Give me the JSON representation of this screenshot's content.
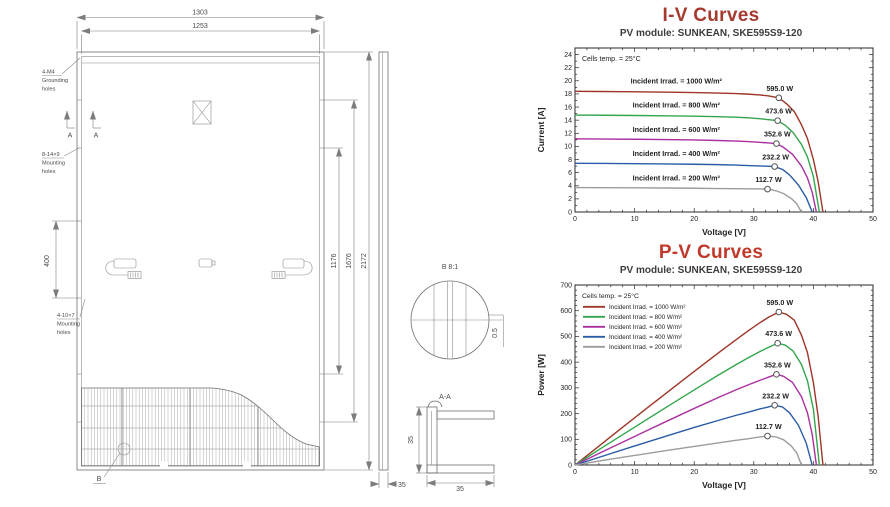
{
  "drawing": {
    "dims": {
      "width_total": "1303",
      "width_glass": "1253",
      "height_inner_holes": "1176",
      "height_outer_holes": "1676",
      "height_total": "2172",
      "hole_pitch": "400",
      "side_frame_width": "35",
      "section_height": "35",
      "section_width": "35",
      "cell_gap": "0.5"
    },
    "labels": {
      "grounding": [
        "4-M4",
        "Grounding",
        "holes"
      ],
      "mounting_upper": [
        "8-14×9",
        "Mounting",
        "holes"
      ],
      "mounting_lower": [
        "4-10×7",
        "Mounting",
        "holes"
      ],
      "section_marker": "A",
      "section_view": "A-A",
      "detail_marker": "B",
      "detail_view": "B 8:1"
    }
  },
  "chart_data": [
    {
      "type": "line",
      "title": "I-V Curves",
      "title_color": "#a63a2e",
      "subtitle": "PV module: SUNKEAN, SKE595S9-120",
      "xlabel": "Voltage [V]",
      "ylabel": "Current [A]",
      "xlim": [
        0,
        50
      ],
      "ylim": [
        0,
        25
      ],
      "xticks": [
        0,
        10,
        20,
        30,
        40,
        50
      ],
      "yticks": [
        0,
        2,
        4,
        6,
        8,
        10,
        12,
        14,
        16,
        18,
        20,
        22,
        24
      ],
      "x_minor": 2,
      "y_minor": 1,
      "note": "Cells temp. = 25°C",
      "legend": "inline",
      "series": [
        {
          "name": "Incident Irrad. = 1000 W/m²",
          "color": "#9e3528",
          "label_at": [
            17,
            19.6
          ],
          "mpp": [
            34.2,
            17.4
          ],
          "mpp_label": "595.0 W",
          "points": [
            [
              0,
              18.4
            ],
            [
              4,
              18.37
            ],
            [
              8,
              18.34
            ],
            [
              12,
              18.3
            ],
            [
              16,
              18.26
            ],
            [
              20,
              18.2
            ],
            [
              24,
              18.13
            ],
            [
              27,
              18.05
            ],
            [
              29,
              17.97
            ],
            [
              31,
              17.85
            ],
            [
              32.5,
              17.7
            ],
            [
              34.2,
              17.4
            ],
            [
              35.5,
              16.5
            ],
            [
              36.8,
              15.3
            ],
            [
              38,
              13.3
            ],
            [
              39,
              11.2
            ],
            [
              40,
              8.0
            ],
            [
              40.8,
              4.6
            ],
            [
              41.6,
              0
            ]
          ]
        },
        {
          "name": "Incident Irrad. = 800 W/m²",
          "color": "#33a64c",
          "label_at": [
            17,
            15.9
          ],
          "mpp": [
            34,
            13.93
          ],
          "mpp_label": "473.6 W",
          "points": [
            [
              0,
              14.78
            ],
            [
              5,
              14.75
            ],
            [
              10,
              14.71
            ],
            [
              15,
              14.66
            ],
            [
              20,
              14.6
            ],
            [
              24,
              14.53
            ],
            [
              27,
              14.45
            ],
            [
              29,
              14.36
            ],
            [
              31,
              14.22
            ],
            [
              32.5,
              14.08
            ],
            [
              34,
              13.93
            ],
            [
              35.3,
              13.2
            ],
            [
              36.6,
              12.1
            ],
            [
              38,
              10.3
            ],
            [
              39,
              8.4
            ],
            [
              40,
              5.4
            ],
            [
              41,
              0
            ]
          ]
        },
        {
          "name": "Incident Irrad. = 600 W/m²",
          "color": "#aa30a0",
          "label_at": [
            17,
            12.2
          ],
          "mpp": [
            33.8,
            10.43
          ],
          "mpp_label": "352.6 W",
          "points": [
            [
              0,
              11.15
            ],
            [
              5,
              11.12
            ],
            [
              10,
              11.09
            ],
            [
              15,
              11.04
            ],
            [
              20,
              10.98
            ],
            [
              24,
              10.9
            ],
            [
              27,
              10.82
            ],
            [
              29,
              10.73
            ],
            [
              31,
              10.62
            ],
            [
              32.5,
              10.52
            ],
            [
              33.8,
              10.43
            ],
            [
              35,
              9.85
            ],
            [
              36.5,
              8.8
            ],
            [
              38,
              7.0
            ],
            [
              39,
              5.2
            ],
            [
              39.8,
              3.0
            ],
            [
              40.5,
              0
            ]
          ]
        },
        {
          "name": "Incident Irrad. = 400 W/m²",
          "color": "#2a5ca8",
          "label_at": [
            17,
            8.5
          ],
          "mpp": [
            33.5,
            6.93
          ],
          "mpp_label": "232.2 W",
          "points": [
            [
              0,
              7.42
            ],
            [
              5,
              7.4
            ],
            [
              10,
              7.37
            ],
            [
              15,
              7.33
            ],
            [
              20,
              7.28
            ],
            [
              24,
              7.22
            ],
            [
              27,
              7.15
            ],
            [
              29,
              7.08
            ],
            [
              31,
              7.02
            ],
            [
              32.3,
              6.98
            ],
            [
              33.5,
              6.93
            ],
            [
              34.8,
              6.5
            ],
            [
              36,
              5.65
            ],
            [
              37.5,
              4.1
            ],
            [
              38.8,
              2.2
            ],
            [
              39.8,
              0
            ]
          ]
        },
        {
          "name": "Incident Irrad. = 200 W/m²",
          "color": "#9c9c9c",
          "label_at": [
            17,
            4.8
          ],
          "mpp": [
            32.3,
            3.49
          ],
          "mpp_label": "112.7 W",
          "points": [
            [
              0,
              3.72
            ],
            [
              5,
              3.71
            ],
            [
              10,
              3.69
            ],
            [
              15,
              3.66
            ],
            [
              20,
              3.62
            ],
            [
              24,
              3.58
            ],
            [
              27,
              3.55
            ],
            [
              29,
              3.53
            ],
            [
              31,
              3.51
            ],
            [
              32.3,
              3.49
            ],
            [
              33.8,
              3.22
            ],
            [
              35,
              2.8
            ],
            [
              36.3,
              2.05
            ],
            [
              37.2,
              1.25
            ],
            [
              38,
              0
            ]
          ]
        }
      ]
    },
    {
      "type": "line",
      "title": "P-V Curves",
      "title_color": "#c0392b",
      "subtitle": "PV module: SUNKEAN, SKE595S9-120",
      "xlabel": "Voltage [V]",
      "ylabel": "Power [W]",
      "xlim": [
        0,
        50
      ],
      "ylim": [
        0,
        700
      ],
      "xticks": [
        0,
        10,
        20,
        30,
        40,
        50
      ],
      "yticks": [
        0,
        100,
        200,
        300,
        400,
        500,
        600,
        700
      ],
      "x_minor": 2,
      "y_minor": 20,
      "note": "Cells temp. = 25°C",
      "legend": "box",
      "series": [
        {
          "name": "Incident Irrad. = 1000 W/m²",
          "color": "#9e3528",
          "mpp": [
            34.2,
            595
          ],
          "mpp_label": "595.0 W",
          "points": [
            [
              0,
              0
            ],
            [
              4,
              73
            ],
            [
              8,
              147
            ],
            [
              12,
              220
            ],
            [
              16,
              292
            ],
            [
              20,
              364
            ],
            [
              24,
              435
            ],
            [
              27,
              487
            ],
            [
              29,
              521
            ],
            [
              31,
              553
            ],
            [
              32.5,
              575
            ],
            [
              34.2,
              595
            ],
            [
              35.5,
              586
            ],
            [
              36.8,
              563
            ],
            [
              38,
              505
            ],
            [
              39,
              437
            ],
            [
              40,
              320
            ],
            [
              40.8,
              188
            ],
            [
              41.6,
              0
            ]
          ]
        },
        {
          "name": "Incident Irrad. = 800 W/m²",
          "color": "#33a64c",
          "mpp": [
            34,
            473.6
          ],
          "mpp_label": "473.6 W",
          "points": [
            [
              0,
              0
            ],
            [
              5,
              74
            ],
            [
              10,
              147
            ],
            [
              15,
              220
            ],
            [
              20,
              292
            ],
            [
              24,
              349
            ],
            [
              27,
              390
            ],
            [
              29,
              416
            ],
            [
              31,
              441
            ],
            [
              32.5,
              458
            ],
            [
              34,
              473.6
            ],
            [
              35.3,
              466
            ],
            [
              36.6,
              443
            ],
            [
              38,
              391
            ],
            [
              39,
              328
            ],
            [
              40,
              216
            ],
            [
              41,
              0
            ]
          ]
        },
        {
          "name": "Incident Irrad. = 600 W/m²",
          "color": "#aa30a0",
          "mpp": [
            33.8,
            352.6
          ],
          "mpp_label": "352.6 W",
          "points": [
            [
              0,
              0
            ],
            [
              5,
              56
            ],
            [
              10,
              111
            ],
            [
              15,
              166
            ],
            [
              20,
              220
            ],
            [
              24,
              262
            ],
            [
              27,
              292
            ],
            [
              29,
              311
            ],
            [
              31,
              329
            ],
            [
              32.5,
              342
            ],
            [
              33.8,
              352.6
            ],
            [
              35,
              345
            ],
            [
              36.5,
              321
            ],
            [
              38,
              266
            ],
            [
              39,
              203
            ],
            [
              39.8,
              119
            ],
            [
              40.5,
              0
            ]
          ]
        },
        {
          "name": "Incident Irrad. = 400 W/m²",
          "color": "#2a5ca8",
          "mpp": [
            33.5,
            232.2
          ],
          "mpp_label": "232.2 W",
          "points": [
            [
              0,
              0
            ],
            [
              5,
              37
            ],
            [
              10,
              74
            ],
            [
              15,
              110
            ],
            [
              20,
              146
            ],
            [
              24,
              173
            ],
            [
              27,
              193
            ],
            [
              29,
              205
            ],
            [
              31,
              218
            ],
            [
              32.3,
              225
            ],
            [
              33.5,
              232.2
            ],
            [
              34.8,
              226
            ],
            [
              36,
              203
            ],
            [
              37.5,
              154
            ],
            [
              38.8,
              85
            ],
            [
              39.8,
              0
            ]
          ]
        },
        {
          "name": "Incident Irrad. = 200 W/m²",
          "color": "#9c9c9c",
          "mpp": [
            32.3,
            112.7
          ],
          "mpp_label": "112.7 W",
          "points": [
            [
              0,
              0
            ],
            [
              5,
              19
            ],
            [
              10,
              37
            ],
            [
              15,
              55
            ],
            [
              20,
              72
            ],
            [
              24,
              86
            ],
            [
              27,
              96
            ],
            [
              29,
              102
            ],
            [
              31,
              109
            ],
            [
              32.3,
              112.7
            ],
            [
              33.8,
              109
            ],
            [
              35,
              98
            ],
            [
              36.3,
              74
            ],
            [
              37.2,
              47
            ],
            [
              38,
              0
            ]
          ]
        }
      ]
    }
  ]
}
